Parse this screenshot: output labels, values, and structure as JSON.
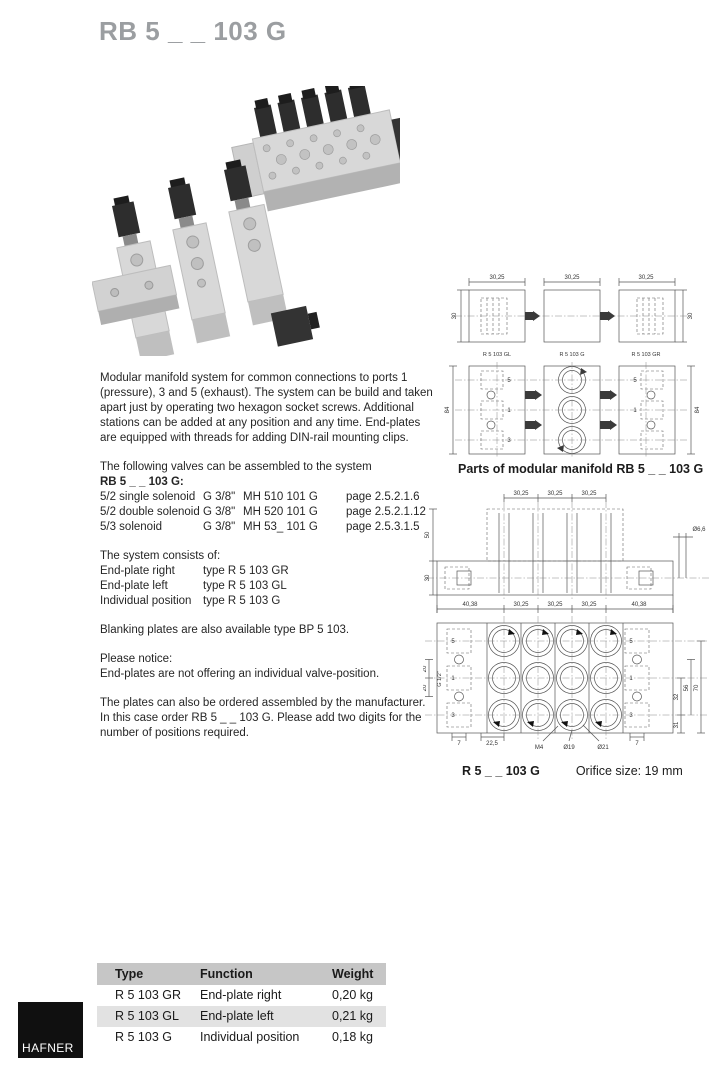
{
  "page": {
    "title": "RB 5 _ _ 103 G"
  },
  "intro": "Modular manifold system for common connections to ports 1 (pressure), 3 and 5 (exhaust). The system can be build and taken apart just by operating two hexagon socket screws. Additional stations can be added at any position and any time. End-plates are equipped with threads for adding DIN-rail mounting clips.",
  "valves": {
    "lead": "The following valves can be assembled to the system",
    "lead_bold": "RB 5 _ _ 103 G:",
    "rows": [
      {
        "function": "5/2 single solenoid",
        "thread": "G 3/8\"",
        "type": "MH 510 101 G",
        "page": "page 2.5.2.1.6"
      },
      {
        "function": "5/2 double solenoid",
        "thread": "G 3/8\"",
        "type": "MH 520 101 G",
        "page": "page 2.5.2.1.12"
      },
      {
        "function": "5/3 solenoid",
        "thread": "G 3/8\"",
        "type": "MH 53_ 101 G",
        "page": "page 2.5.3.1.5"
      }
    ]
  },
  "system": {
    "lead": "The system consists of:",
    "rows": [
      {
        "label": "End-plate right",
        "value": "type R 5 103 GR"
      },
      {
        "label": "End-plate left",
        "value": "type R 5 103 GL"
      },
      {
        "label": "Individual position",
        "value": "type R 5 103 G"
      }
    ]
  },
  "notes": {
    "blanking": "Blanking plates are also available type BP 5 103.",
    "notice_title": "Please notice:",
    "notice_body": "End-plates are not offering an individual valve-position.",
    "ordering": "The plates can also be ordered assembled by the manufacturer. In this case order RB 5 _ _ 103 G. Please add two digits for the number of positions required."
  },
  "fig1": {
    "caption": "Parts of modular manifold RB 5 _ _ 103 G",
    "pitch_dim": "30,25",
    "height_dim_top": "30",
    "height_dim_front": "84",
    "labels": [
      "R 5 103 GL",
      "R 5 103 G",
      "R 5 103 GR"
    ],
    "ports": [
      "5",
      "1",
      "3"
    ]
  },
  "fig2": {
    "caption_type": "R 5 _ _ 103 G",
    "caption_orifice": "Orifice size: 19 mm",
    "pitch_dims": [
      "30,25",
      "30,25",
      "30,25"
    ],
    "side_dims": [
      "50",
      "30"
    ],
    "hole_dia": "Ø6,6",
    "width_dims": [
      "40,38",
      "30,25",
      "30,25",
      "30,25",
      "40,38"
    ],
    "left_dims": [
      "20",
      "20"
    ],
    "port_thread": "G 1/2\"",
    "right_dims": [
      "32",
      "56",
      "70",
      "31"
    ],
    "bottom_dims": [
      "7",
      "22,5",
      "M4",
      "Ø19",
      "Ø21",
      "7"
    ],
    "ports": [
      "5",
      "1",
      "3"
    ]
  },
  "spec_table": {
    "headers": [
      "Type",
      "Function",
      "Weight"
    ],
    "rows": [
      [
        "R 5 103 GR",
        "End-plate right",
        "0,20 kg"
      ],
      [
        "R 5 103 GL",
        "End-plate left",
        "0,21 kg"
      ],
      [
        "R 5 103 G",
        "Individual position",
        "0,18 kg"
      ]
    ]
  },
  "logo": {
    "text": "HAFNER"
  }
}
